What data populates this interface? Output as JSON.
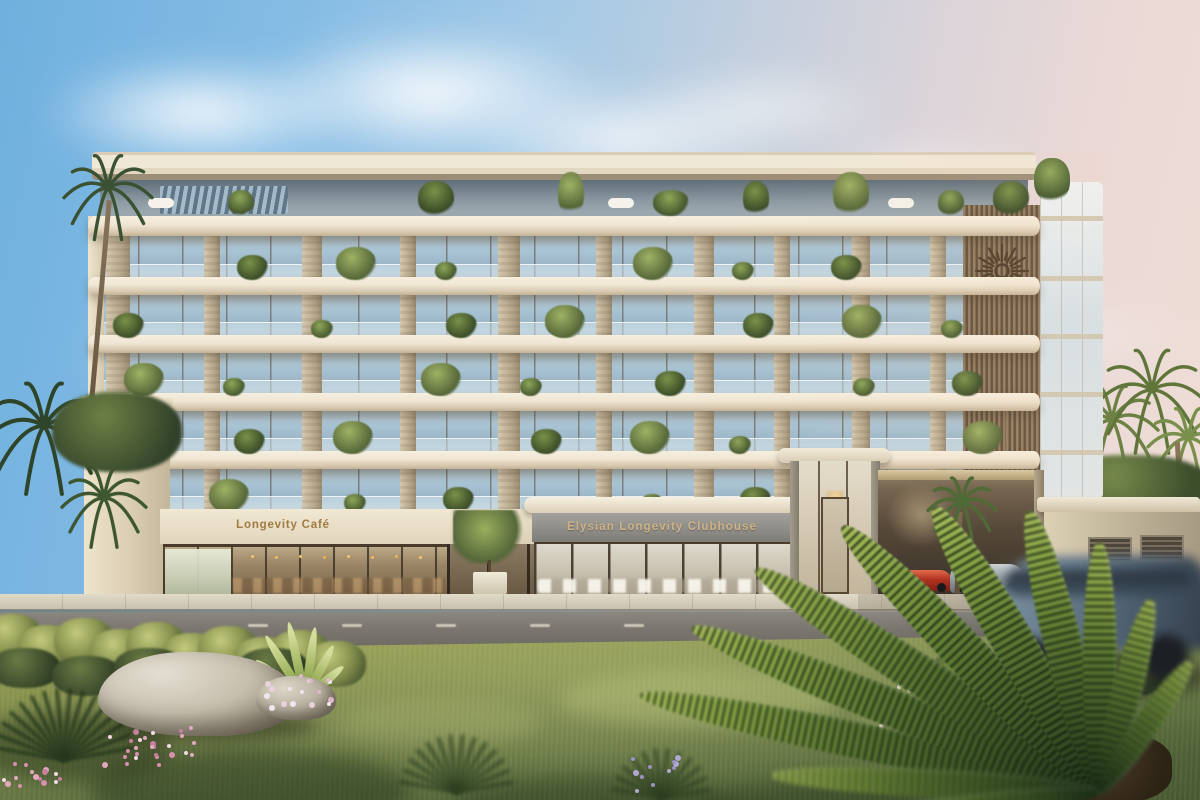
{
  "scene": {
    "type": "architectural rendering",
    "description": "Street view of a 7-storey luxury wellness residence with planted balconies at golden hour"
  },
  "signs": {
    "cafe": "Longevity Café",
    "clubhouse": "Elysian Longevity Clubhouse"
  },
  "branding": {
    "logo": "sunburst-emblem"
  },
  "vehicles": {
    "parked": [
      "red sports car",
      "silver sports car"
    ],
    "moving": "blue SUV with motion blur"
  },
  "colors": {
    "sky_left": "#6fb0de",
    "sky_right": "#f0ded5",
    "slab": "#efe5d2",
    "slab_shadow": "#b9a88f",
    "glass": "#a8c3d3",
    "stone": "#c6b79f",
    "wood_slats": "#8a7358",
    "sign_gold": "#a07a42",
    "clubhouse_fascia": "#8a8883",
    "road": "#6b6861",
    "sidewalk": "#cec7b7",
    "grass_lit": "#99a25e",
    "grass_shadow": "#465630",
    "foliage_dark": "#2f452a",
    "foliage_lit": "#8fa655",
    "rock": "#c6bfae",
    "car_red": "#b23322",
    "car_silver": "#99a3a8",
    "car_suv": "#5c7285",
    "flower_pink": "#e3a8c0"
  }
}
